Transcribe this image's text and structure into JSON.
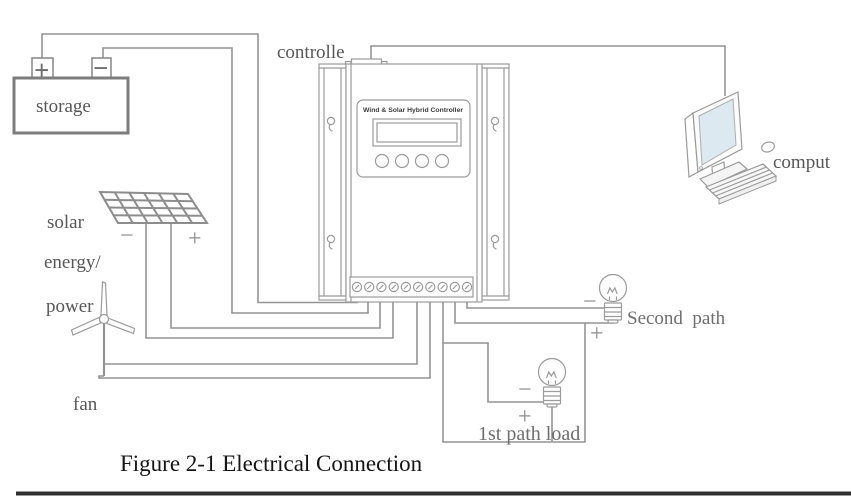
{
  "diagram": {
    "caption": "Figure 2-1 Electrical Connection",
    "battery": {
      "label": "storage",
      "plus": "+",
      "minus": "−"
    },
    "controller": {
      "label": "controlle",
      "panel_title": "Wind & Solar Hybrid Controller"
    },
    "solar": {
      "line1": "solar",
      "line2": "energy/",
      "line3": "power",
      "minus": "−",
      "plus": "+"
    },
    "fan": {
      "label": "fan"
    },
    "computer": {
      "label": "comput"
    },
    "second_path": {
      "label": "Second  path",
      "minus": "−",
      "plus": "+"
    },
    "first_path": {
      "label": "1st path load",
      "minus": "−",
      "plus": "+"
    }
  },
  "colors": {
    "wire": "#949494",
    "outline": "#9b9b9b",
    "label_text": "#575757",
    "caption_text": "#151515",
    "monitor_screen": "#dce9f1",
    "bottom_strip": "#2f2f2f"
  }
}
